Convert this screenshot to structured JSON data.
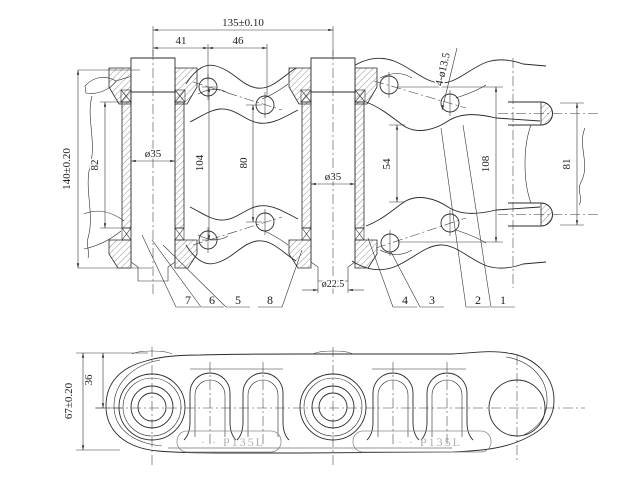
{
  "drawing": {
    "colors": {
      "line": "#2b2b2b",
      "dimension": "#333333",
      "marking": "#b0b0b0",
      "background": "#ffffff"
    },
    "main_view": {
      "dim_labels": {
        "pitch": "135±0.10",
        "pin_to_hole": "41",
        "hole_to_hole": "46",
        "overall_height": "140±0.20",
        "bushing_length": "82",
        "link_hole_span_outer": "104",
        "link_hole_span_inner": "80",
        "link_gap": "54",
        "pin_row_span": "108",
        "pin_end_span": "81",
        "bore_left": "ø35",
        "bore_right": "ø35",
        "pin_end_dia": "ø22.5",
        "bolt_holes": "4-ø13.5"
      },
      "callouts": [
        "7",
        "6",
        "5",
        "8",
        "4",
        "3",
        "2",
        "1"
      ]
    },
    "bottom_view": {
      "dim_labels": {
        "shoe_height": "67±0.20",
        "hole_offset": "36"
      },
      "markings": [
        "· · P135L",
        "· · P135L"
      ]
    }
  }
}
